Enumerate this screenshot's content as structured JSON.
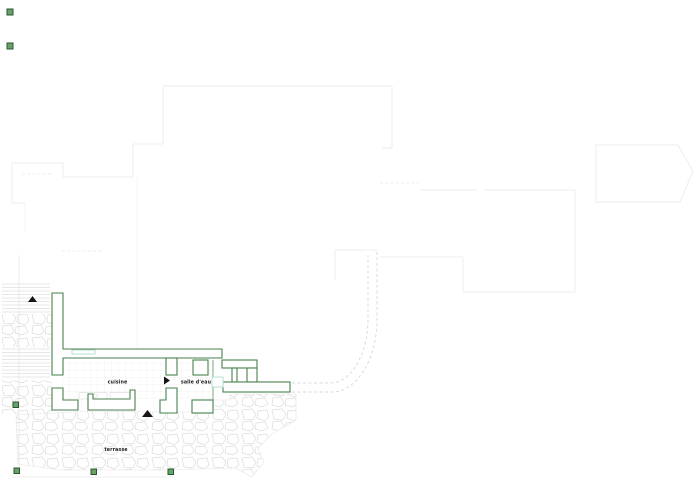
{
  "plan": {
    "room_labels": {
      "kitchen": "cuisine",
      "bathroom": "salle d'eau",
      "terrace": "terrasse"
    }
  },
  "colors": {
    "wall": "#47804d",
    "faint": "#e9e9e9",
    "dash": "#d8d8d8",
    "win": "#bcdcd2",
    "tri": "#151515",
    "mfill": "#6aa06c",
    "mstroke": "#25592e",
    "text": "#222222",
    "stone": "#dcdcdc",
    "grid": "#e6e6e6"
  }
}
